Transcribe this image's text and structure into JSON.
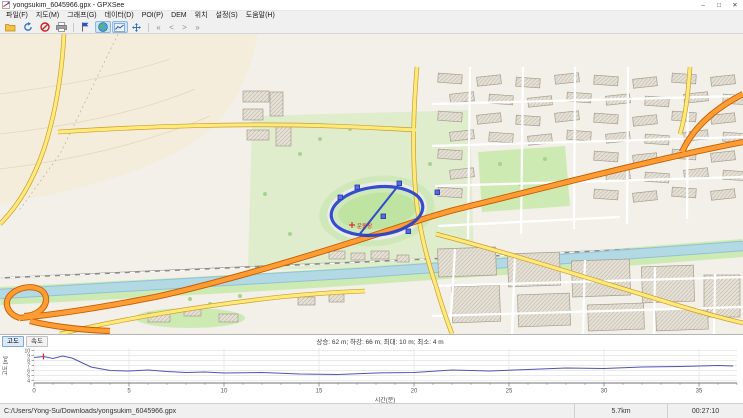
{
  "window": {
    "title": "yongsukim_6045966.gpx - GPXSee",
    "min": "–",
    "max": "□",
    "close": "✕"
  },
  "menu": {
    "items": [
      {
        "label": "파일(F)"
      },
      {
        "label": "지도(M)"
      },
      {
        "label": "그래프(G)"
      },
      {
        "label": "데이터(D)"
      },
      {
        "label": "POI(P)"
      },
      {
        "label": "DEM"
      },
      {
        "label": "위치"
      },
      {
        "label": "설정(S)"
      },
      {
        "label": "도움말(H)"
      }
    ]
  },
  "toolbar": {
    "nav": [
      "«",
      "<",
      ">",
      "»"
    ]
  },
  "map": {
    "coords": "37.2862N 126.9670E, 24 m",
    "poi_label": "운동장",
    "scalebar": {
      "start": "0",
      "mid": "100",
      "end": "200 m"
    }
  },
  "chart_data": {
    "type": "line",
    "tabs": [
      "고도",
      "속도"
    ],
    "stats": "상승: 62 m; 하강: 66 m; 최대: 10 m; 최소: 4 m",
    "xlabel": "시간(분)",
    "ylabel": "고도 [m]",
    "xlim": [
      0,
      37
    ],
    "ylim": [
      3.5,
      10.5
    ],
    "xticks": [
      0,
      5,
      10,
      15,
      20,
      25,
      30,
      35
    ],
    "yticks": [
      4,
      5,
      6,
      7,
      8,
      9,
      10
    ],
    "line_color": "#5055b0",
    "marker": {
      "x": 0.5,
      "color": "#e02020"
    },
    "series": [
      {
        "name": "고도",
        "x": [
          0,
          0.5,
          1,
          1.5,
          2,
          2.5,
          3,
          4,
          5,
          6,
          7,
          8,
          9,
          10,
          12,
          14,
          16,
          18,
          20,
          22,
          24,
          26,
          28,
          30,
          32,
          34,
          36,
          36.8
        ],
        "y": [
          8.6,
          8.8,
          8.4,
          8.9,
          8.5,
          7.6,
          6.7,
          6.0,
          5.9,
          6.1,
          5.8,
          5.6,
          5.7,
          5.5,
          5.6,
          5.3,
          5.2,
          5.5,
          5.6,
          6.1,
          5.9,
          6.2,
          6.5,
          6.4,
          6.7,
          6.8,
          7.0,
          6.9
        ]
      }
    ]
  },
  "statusbar": {
    "file_path": "C:/Users/Yong-Su/Downloads/yongsukim_6045966.gpx",
    "distance": "5.7km",
    "duration": "00:27:10"
  }
}
